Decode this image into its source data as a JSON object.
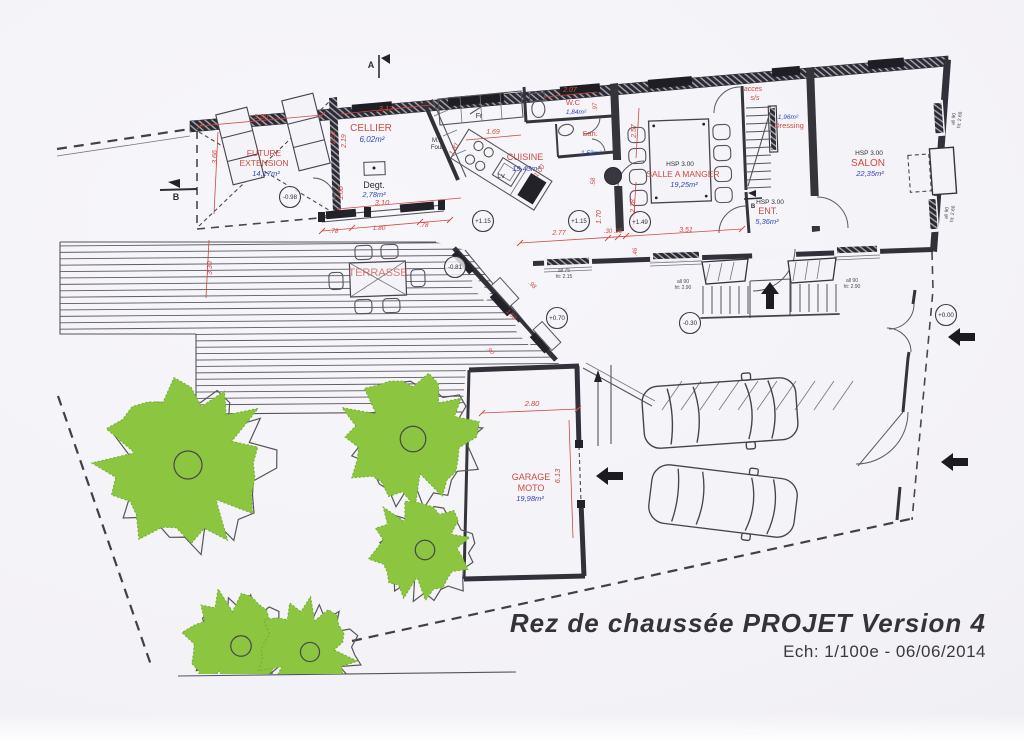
{
  "document": {
    "title": "Rez de chaussée PROJET Version 4",
    "subtitle": "Ech: 1/100e - 06/06/2014"
  },
  "colors": {
    "paper": "#f4f3f7",
    "line": "#32313a",
    "red": "#cf4a42",
    "blue": "#2f46bf",
    "ink": "#2e2d34",
    "gray": "#4a4950",
    "green": "#8cc53f",
    "green_edge": "#6fae2f"
  },
  "rooms": [
    {
      "name": "FUTURE EXTENSION",
      "area": "14,17m²"
    },
    {
      "name": "CELLIER",
      "area": "6,02m²"
    },
    {
      "name": "Degt.",
      "area": "2,78m²"
    },
    {
      "name": "CUISINE",
      "area": "19,43m²"
    },
    {
      "name": "W.C",
      "area": "1,84m²"
    },
    {
      "name": "San.",
      "area": "1,52m²"
    },
    {
      "name": "SALLE A MANGER",
      "area": "19,25m²",
      "hsp": "HSP 3.00"
    },
    {
      "name": "Dressing",
      "area": "1,96m²"
    },
    {
      "name": "ENT.",
      "area": "5,36m²",
      "hsp": "HSP 3.00"
    },
    {
      "name": "SALON",
      "area": "22,35m²",
      "hsp": "HSP 3.00"
    },
    {
      "name": "TERRASSE"
    },
    {
      "name": "GARAGE MOTO",
      "area": "19,98m²"
    }
  ],
  "labels": [
    {
      "t": "FUTURE",
      "x": 264,
      "y": 156,
      "s": 8.5,
      "c": "r",
      "n": "room-future-extension"
    },
    {
      "t": "EXTENSION",
      "x": 264,
      "y": 166,
      "s": 8.5,
      "c": "r",
      "n": "room-future-extension"
    },
    {
      "t": "14,17m²",
      "x": 266,
      "y": 176,
      "s": 7.5,
      "c": "b",
      "i": 1,
      "n": "area-future-extension"
    },
    {
      "t": "CELLIER",
      "x": 371,
      "y": 131,
      "s": 10,
      "c": "r",
      "n": "room-cellier"
    },
    {
      "t": "6,02m²",
      "x": 372,
      "y": 142,
      "s": 8,
      "c": "b",
      "i": 1,
      "n": "area-cellier"
    },
    {
      "t": "Degt.",
      "x": 374,
      "y": 188,
      "s": 9,
      "c": "k",
      "n": "room-degagement"
    },
    {
      "t": "2,78m²",
      "x": 374,
      "y": 197,
      "s": 7.5,
      "c": "b",
      "i": 1,
      "n": "area-degagement"
    },
    {
      "t": "3.10",
      "x": 382,
      "y": 205,
      "s": 7.5,
      "c": "r",
      "i": 1
    },
    {
      "t": "CUISINE",
      "x": 525,
      "y": 160,
      "s": 9,
      "c": "r",
      "n": "room-cuisine"
    },
    {
      "t": "19,43m²",
      "x": 526,
      "y": 171,
      "s": 7.5,
      "c": "b",
      "i": 1,
      "n": "area-cuisine"
    },
    {
      "t": "W.C",
      "x": 573,
      "y": 105,
      "s": 7.5,
      "c": "r",
      "n": "room-wc"
    },
    {
      "t": "1,84m²",
      "x": 576,
      "y": 114,
      "s": 6.5,
      "c": "b",
      "i": 1,
      "n": "area-wc"
    },
    {
      "t": "San.",
      "x": 590,
      "y": 136,
      "s": 7.5,
      "c": "r",
      "n": "room-sanitaires"
    },
    {
      "t": "1,52m²",
      "x": 591,
      "y": 155,
      "s": 6.5,
      "c": "b",
      "i": 1,
      "n": "area-sanitaires"
    },
    {
      "t": "HSP 3.00",
      "x": 680,
      "y": 166,
      "s": 6.5,
      "c": "k",
      "n": "hsp-salle-a-manger"
    },
    {
      "t": "SALLE A MANGER",
      "x": 683,
      "y": 177,
      "s": 8.5,
      "c": "r",
      "n": "room-salle-a-manger"
    },
    {
      "t": "19,25m²",
      "x": 684,
      "y": 187,
      "s": 7.5,
      "c": "b",
      "i": 1,
      "n": "area-salle-a-manger"
    },
    {
      "t": "acces",
      "x": 753,
      "y": 91,
      "s": 7,
      "c": "r",
      "i": 1
    },
    {
      "t": "s/s",
      "x": 755,
      "y": 100,
      "s": 7,
      "c": "r",
      "i": 1
    },
    {
      "t": "1,96m²",
      "x": 788,
      "y": 119,
      "s": 6.5,
      "c": "b",
      "i": 1,
      "n": "area-dressing"
    },
    {
      "t": "Dressing",
      "x": 789,
      "y": 128,
      "s": 7.5,
      "c": "r",
      "n": "room-dressing"
    },
    {
      "t": "HSP 3.00",
      "x": 770,
      "y": 204,
      "s": 6.5,
      "c": "k",
      "n": "hsp-entree"
    },
    {
      "t": "ENT.",
      "x": 768,
      "y": 214,
      "s": 9,
      "c": "r",
      "n": "room-entree"
    },
    {
      "t": "5,36m²",
      "x": 767,
      "y": 224,
      "s": 7.5,
      "c": "b",
      "i": 1,
      "n": "area-entree"
    },
    {
      "t": "HSP 3.00",
      "x": 869,
      "y": 155,
      "s": 6.5,
      "c": "k",
      "n": "hsp-salon"
    },
    {
      "t": "SALON",
      "x": 868,
      "y": 166,
      "s": 10,
      "c": "r",
      "n": "room-salon"
    },
    {
      "t": "22,35m²",
      "x": 870,
      "y": 176,
      "s": 7.5,
      "c": "b",
      "i": 1,
      "n": "area-salon"
    },
    {
      "t": "TERRASSE",
      "x": 378,
      "y": 276,
      "s": 11,
      "c": "r",
      "o": 0.7,
      "n": "room-terrasse"
    },
    {
      "t": "GARAGE",
      "x": 531,
      "y": 480,
      "s": 9,
      "c": "r",
      "n": "room-garage-moto"
    },
    {
      "t": "MOTO",
      "x": 531,
      "y": 491,
      "s": 9,
      "c": "r",
      "n": "room-garage-moto"
    },
    {
      "t": "19,98m²",
      "x": 530,
      "y": 501,
      "s": 7.5,
      "c": "b",
      "i": 1,
      "n": "area-garage-moto"
    },
    {
      "t": "3.80",
      "x": 261,
      "y": 119,
      "s": 7.5,
      "c": "r",
      "i": 1
    },
    {
      "t": "3.17",
      "x": 386,
      "y": 111,
      "s": 7.5,
      "c": "r",
      "i": 1
    },
    {
      "t": "2.07",
      "x": 570,
      "y": 92,
      "s": 7,
      "c": "r",
      "i": 1
    },
    {
      "t": "1.69",
      "x": 493,
      "y": 134,
      "s": 7,
      "c": "r",
      "i": 1
    },
    {
      "t": "2.77",
      "x": 559,
      "y": 235,
      "s": 7,
      "c": "r",
      "i": 1
    },
    {
      "t": ".30",
      "x": 608,
      "y": 233,
      "s": 6,
      "c": "r",
      "i": 1
    },
    {
      "t": ".25",
      "x": 618,
      "y": 233,
      "s": 6,
      "c": "r",
      "i": 1
    },
    {
      "t": "3.51",
      "x": 686,
      "y": 232,
      "s": 7,
      "c": "r",
      "i": 1
    },
    {
      "t": "2.80",
      "x": 532,
      "y": 406,
      "s": 7.5,
      "c": "r",
      "i": 1
    },
    {
      "t": ".78",
      "x": 334,
      "y": 233,
      "s": 6.5,
      "c": "r",
      "i": 1
    },
    {
      "t": "1.80",
      "x": 379,
      "y": 230,
      "s": 6.5,
      "c": "r",
      "i": 1
    },
    {
      "t": ".78",
      "x": 424,
      "y": 227,
      "s": 6.5,
      "c": "r",
      "i": 1
    },
    {
      "t": "3.66",
      "x": 217,
      "y": 157,
      "s": 7,
      "c": "r",
      "i": 1,
      "r": -90
    },
    {
      "t": "2.52",
      "x": 335,
      "y": 137,
      "s": 7,
      "c": "r",
      "i": 1,
      "r": -90
    },
    {
      "t": "2.19",
      "x": 346,
      "y": 141,
      "s": 7,
      "c": "r",
      "i": 1,
      "r": -90
    },
    {
      "t": "1.00",
      "x": 343,
      "y": 193,
      "s": 7,
      "c": "r",
      "i": 1,
      "r": -90
    },
    {
      "t": "3.30",
      "x": 212,
      "y": 268,
      "s": 7,
      "c": "r",
      "i": 1,
      "r": -90
    },
    {
      "t": "2.57",
      "x": 636,
      "y": 131,
      "s": 7,
      "c": "r",
      "i": 1,
      "r": -90
    },
    {
      "t": "2.28",
      "x": 635,
      "y": 206,
      "s": 7,
      "c": "r",
      "i": 1,
      "r": -90
    },
    {
      "t": "1.70",
      "x": 601,
      "y": 217,
      "s": 7,
      "c": "r",
      "i": 1,
      "r": -90
    },
    {
      "t": ".58",
      "x": 595,
      "y": 182,
      "s": 6,
      "c": "r",
      "i": 1,
      "r": -90
    },
    {
      "t": ".97",
      "x": 597,
      "y": 107,
      "s": 6,
      "c": "r",
      "i": 1,
      "r": -90
    },
    {
      "t": ".46",
      "x": 637,
      "y": 252,
      "s": 6,
      "c": "r",
      "i": 1,
      "r": -90
    },
    {
      "t": "6.13",
      "x": 560,
      "y": 476,
      "s": 7.5,
      "c": "r",
      "i": 1,
      "r": -90
    },
    {
      "t": "1.81",
      "x": 456,
      "y": 150,
      "s": 7,
      "c": "r",
      "i": 1,
      "r": -60
    },
    {
      "t": "1.00",
      "x": 541,
      "y": 172,
      "s": 7,
      "c": "r",
      "i": 1,
      "r": -55
    },
    {
      "t": ".98",
      "x": 531,
      "y": 286,
      "s": 6,
      "c": "r",
      "i": 1,
      "r": 44
    },
    {
      "t": "1.60",
      "x": 510,
      "y": 316,
      "s": 6,
      "c": "r",
      "i": 1,
      "r": 44
    },
    {
      "t": ".90",
      "x": 489,
      "y": 352,
      "s": 6,
      "c": "r",
      "i": 1,
      "r": 44
    },
    {
      "t": "all 75",
      "x": 564,
      "y": 272,
      "s": 5,
      "c": "g"
    },
    {
      "t": "ht: 2.15",
      "x": 564,
      "y": 278,
      "s": 5,
      "c": "g"
    },
    {
      "t": "all 90",
      "x": 683,
      "y": 283,
      "s": 5,
      "c": "g"
    },
    {
      "t": "ht: 2.90",
      "x": 683,
      "y": 289,
      "s": 5,
      "c": "g"
    },
    {
      "t": "all 90",
      "x": 852,
      "y": 282,
      "s": 5,
      "c": "g"
    },
    {
      "t": "ht: 2.90",
      "x": 852,
      "y": 288,
      "s": 5,
      "c": "g"
    },
    {
      "t": "all 90",
      "x": 955,
      "y": 119,
      "s": 5,
      "c": "g",
      "r": -84
    },
    {
      "t": "ht: 2.66",
      "x": 961,
      "y": 120,
      "s": 5,
      "c": "g",
      "r": -84
    },
    {
      "t": "all 90",
      "x": 948,
      "y": 213,
      "s": 5,
      "c": "g",
      "r": -84
    },
    {
      "t": "ht: 2.66",
      "x": 954,
      "y": 214,
      "s": 5,
      "c": "g",
      "r": -84
    },
    {
      "t": "M.o",
      "x": 437,
      "y": 142,
      "s": 6,
      "c": "k"
    },
    {
      "t": "Four",
      "x": 437,
      "y": 149,
      "s": 6,
      "c": "k"
    },
    {
      "t": "Fr",
      "x": 479,
      "y": 118,
      "s": 7,
      "c": "k"
    },
    {
      "t": "Lv",
      "x": 501,
      "y": 178,
      "s": 7,
      "c": "k"
    },
    {
      "t": "A",
      "x": 371,
      "y": 68,
      "s": 9,
      "c": "k",
      "w": 1
    },
    {
      "t": "B",
      "x": 176,
      "y": 200,
      "s": 9,
      "c": "k",
      "w": 1
    },
    {
      "t": "B",
      "x": 753,
      "y": 208,
      "s": 6,
      "c": "k",
      "w": 1
    }
  ],
  "levels": [
    {
      "t": "-0.98",
      "x": 290,
      "y": 197
    },
    {
      "t": "-0.81",
      "x": 455,
      "y": 267
    },
    {
      "t": "+1.15",
      "x": 483,
      "y": 221
    },
    {
      "t": "+1.15",
      "x": 579,
      "y": 221
    },
    {
      "t": "+1.49",
      "x": 640,
      "y": 222
    },
    {
      "t": "+0.70",
      "x": 557,
      "y": 318
    },
    {
      "t": "-0.30",
      "x": 690,
      "y": 323
    },
    {
      "t": "+0.00",
      "x": 946,
      "y": 315
    }
  ],
  "arrows": [
    {
      "x": 948,
      "y": 337,
      "d": "left",
      "n": "entrance-arrow-upper"
    },
    {
      "x": 941,
      "y": 462,
      "d": "left",
      "n": "entrance-arrow-lower"
    },
    {
      "x": 596,
      "y": 476,
      "d": "left",
      "n": "garage-arrow"
    },
    {
      "x": 770,
      "y": 282,
      "d": "up",
      "n": "front-door-arrow"
    }
  ],
  "trees": [
    {
      "cx": 183,
      "cy": 463,
      "r": 90,
      "seed": 1
    },
    {
      "cx": 408,
      "cy": 437,
      "r": 71,
      "seed": 2
    },
    {
      "cx": 420,
      "cy": 548,
      "r": 54,
      "seed": 3
    },
    {
      "cx": 236,
      "cy": 644,
      "r": 57,
      "seed": 4,
      "clip": 1
    },
    {
      "cx": 305,
      "cy": 650,
      "r": 53,
      "seed": 5,
      "clip": 1
    }
  ],
  "section_markers": [
    {
      "label": "A"
    },
    {
      "label": "B"
    },
    {
      "label": "B"
    }
  ]
}
